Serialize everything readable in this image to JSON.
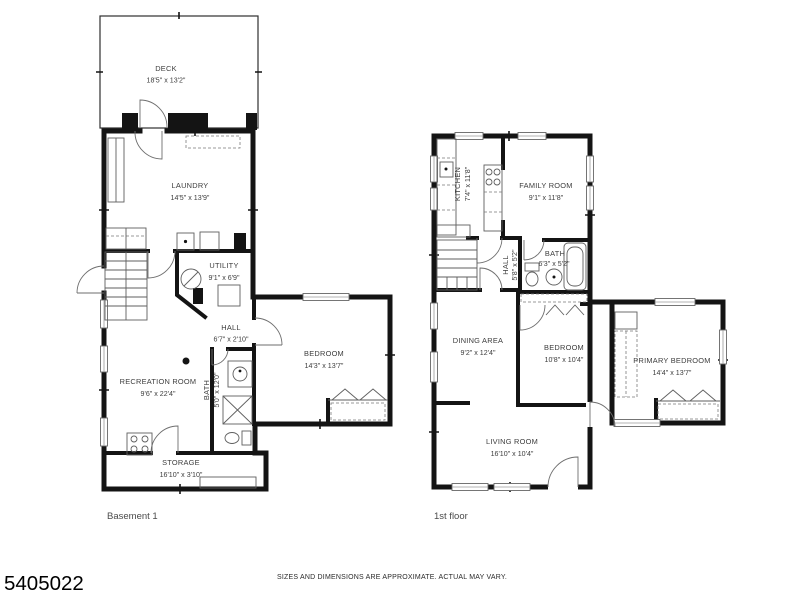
{
  "meta": {
    "listing_id": "5405022",
    "disclaimer": "SIZES AND DIMENSIONS ARE APPROXIMATE. ACTUAL MAY VARY."
  },
  "colors": {
    "wall": "#141414",
    "background": "#ffffff",
    "label_text": "#3d3d3d"
  },
  "basement": {
    "floor_label": "Basement 1",
    "rooms": {
      "deck": {
        "name": "DECK",
        "dims": "18'5\" x 13'2\""
      },
      "laundry": {
        "name": "LAUNDRY",
        "dims": "14'5\" x 13'9\""
      },
      "utility": {
        "name": "UTILITY",
        "dims": "9'1\" x 6'9\""
      },
      "hall": {
        "name": "HALL",
        "dims": "6'7\" x 2'10\""
      },
      "bedroom": {
        "name": "BEDROOM",
        "dims": "14'3\" x 13'7\""
      },
      "recreation": {
        "name": "RECREATION ROOM",
        "dims": "9'6\" x 22'4\""
      },
      "bath": {
        "name": "BATH",
        "dims": "5'0\" x 12'0\""
      },
      "storage": {
        "name": "STORAGE",
        "dims": "16'10\" x 3'10\""
      }
    }
  },
  "first_floor": {
    "floor_label": "1st floor",
    "rooms": {
      "kitchen": {
        "name": "KITCHEN",
        "dims": "7'4\" x 11'8\""
      },
      "family": {
        "name": "FAMILY ROOM",
        "dims": "9'1\" x 11'8\""
      },
      "hall": {
        "name": "HALL",
        "dims": "5'8\" x 5'2\""
      },
      "bath": {
        "name": "BATH",
        "dims": "6'3\" x 5'2\""
      },
      "dining": {
        "name": "DINING AREA",
        "dims": "9'2\" x 12'4\""
      },
      "bedroom": {
        "name": "BEDROOM",
        "dims": "10'8\" x 10'4\""
      },
      "primary": {
        "name": "PRIMARY BEDROOM",
        "dims": "14'4\" x 13'7\""
      },
      "living": {
        "name": "LIVING ROOM",
        "dims": "16'10\" x 10'4\""
      }
    }
  }
}
